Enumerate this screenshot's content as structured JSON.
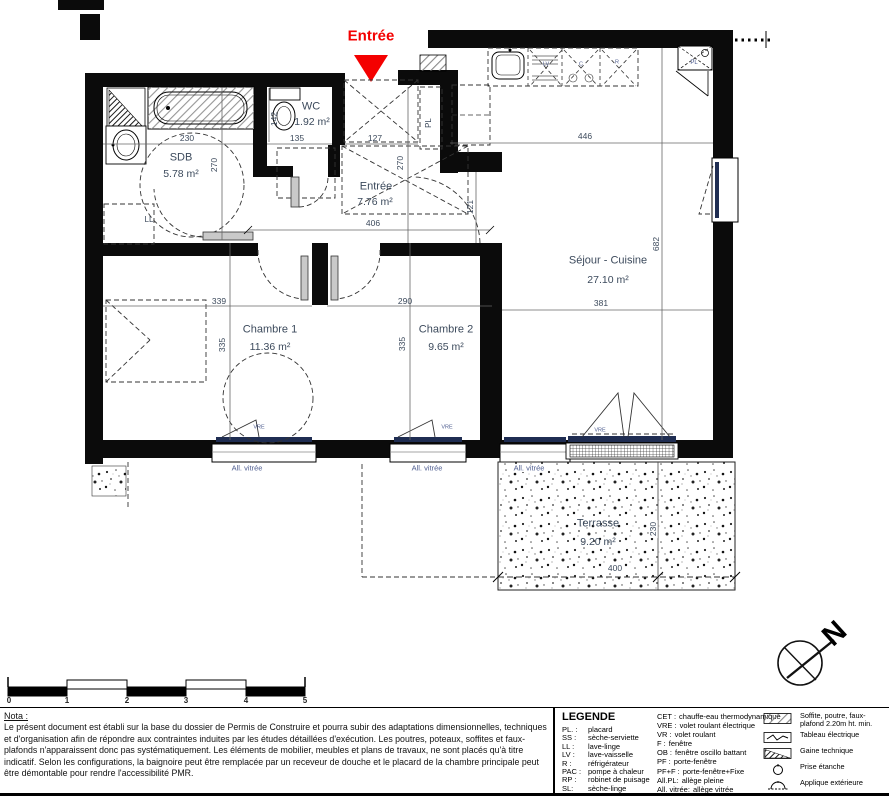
{
  "colors": {
    "accent_red": "#f40000",
    "plan_text": "#3c4a5c",
    "window_blue": "#1f2d52"
  },
  "plan": {
    "entry_marker": "Entrée",
    "rooms": {
      "sdb": {
        "name": "SDB",
        "area": "5.78 m²"
      },
      "wc": {
        "name": "WC",
        "area": "1.92 m²"
      },
      "entree": {
        "name": "Entrée",
        "area": "7.76 m²"
      },
      "sejour": {
        "name": "Séjour - Cuisine",
        "area": "27.10 m²"
      },
      "chambre1": {
        "name": "Chambre 1",
        "area": "11.36 m²"
      },
      "chambre2": {
        "name": "Chambre 2",
        "area": "9.65 m²"
      },
      "terrasse": {
        "name": "Terrasse",
        "area": "9.20 m²"
      }
    },
    "dims": {
      "sdb_w": "230",
      "sdb_h": "270",
      "wc_h": "142",
      "wc_w": "135",
      "entree_w": "127",
      "entree_h": "270",
      "hall_w": "406",
      "passage_h": "121",
      "cuisine_w": "446",
      "sejour_h": "682",
      "sejour_w": "381",
      "c1_w": "339",
      "c1_h": "335",
      "c2_w": "290",
      "c2_h": "335",
      "terrasse_w": "400",
      "terrasse_h": "230"
    },
    "fixtures": {
      "lave_linge": "LL",
      "placard_entree": "PL",
      "placard_cuisine": "PL",
      "lave_vaisselle": "LV",
      "cuisson": "C",
      "refrigerateur": "R"
    },
    "windows": {
      "allege_vitree": "All. vitrée",
      "vre": "VRE"
    }
  },
  "compass": {
    "north": "N"
  },
  "scale_bar": {
    "ticks": [
      "0",
      "1",
      "2",
      "3",
      "4",
      "5"
    ]
  },
  "nota": {
    "title": "Nota :",
    "body": "Le présent document est établi sur la base du dossier de Permis de Construire et pourra subir des adaptations dimensionnelles, techniques et d'organisation afin de répondre aux contraintes induites par les études détaillées d'exécution. Les poutres, poteaux, soffites et faux-plafonds n'apparaissent donc pas systématiquement. Les éléments de mobilier, meubles et plans de travaux, ne sont placés qu'à titre indicatif. Selon les configurations, la baignoire peut être remplacée par un receveur de douche et le placard de la chambre principale peut être démontable pour rendre l'accessibilité PMR."
  },
  "legend": {
    "title": "LEGENDE",
    "col1": [
      {
        "abbr": "PL. :",
        "label": "placard"
      },
      {
        "abbr": "SS :",
        "label": "sèche-serviette"
      },
      {
        "abbr": "LL :",
        "label": "lave-linge"
      },
      {
        "abbr": "LV :",
        "label": "lave-vaisselle"
      },
      {
        "abbr": "R :",
        "label": "réfrigérateur"
      },
      {
        "abbr": "PAC :",
        "label": "pompe à chaleur"
      },
      {
        "abbr": "RP :",
        "label": "robinet de puisage"
      },
      {
        "abbr": "SL:",
        "label": "sèche-linge"
      }
    ],
    "col2": [
      {
        "abbr": "CET :",
        "label": "chauffe-eau thermodynamique"
      },
      {
        "abbr": "VRE :",
        "label": "volet roulant électrique"
      },
      {
        "abbr": "VR :",
        "label": "volet roulant"
      },
      {
        "abbr": "F :",
        "label": "fenêtre"
      },
      {
        "abbr": "OB :",
        "label": "fenêtre oscillo battant"
      },
      {
        "abbr": "PF :",
        "label": "porte-fenêtre"
      },
      {
        "abbr": "PF+F :",
        "label": "porte-fenêtre+Fixe"
      },
      {
        "abbr": "All.PL:",
        "label": "allège pleine"
      },
      {
        "abbr": "All. vitrée:",
        "label": "allège vitrée"
      }
    ],
    "symbols": [
      {
        "icon": "soffite-hatch-icon",
        "label": "Soffite, poutre, faux-plafond 2.20m ht. min."
      },
      {
        "icon": "tableau-electrique-icon",
        "label": "Tableau électrique"
      },
      {
        "icon": "gaine-technique-icon",
        "label": "Gaine technique"
      },
      {
        "icon": "prise-etanche-icon",
        "label": "Prise étanche"
      },
      {
        "icon": "applique-exterieure-icon",
        "label": "Applique extérieure"
      }
    ]
  }
}
